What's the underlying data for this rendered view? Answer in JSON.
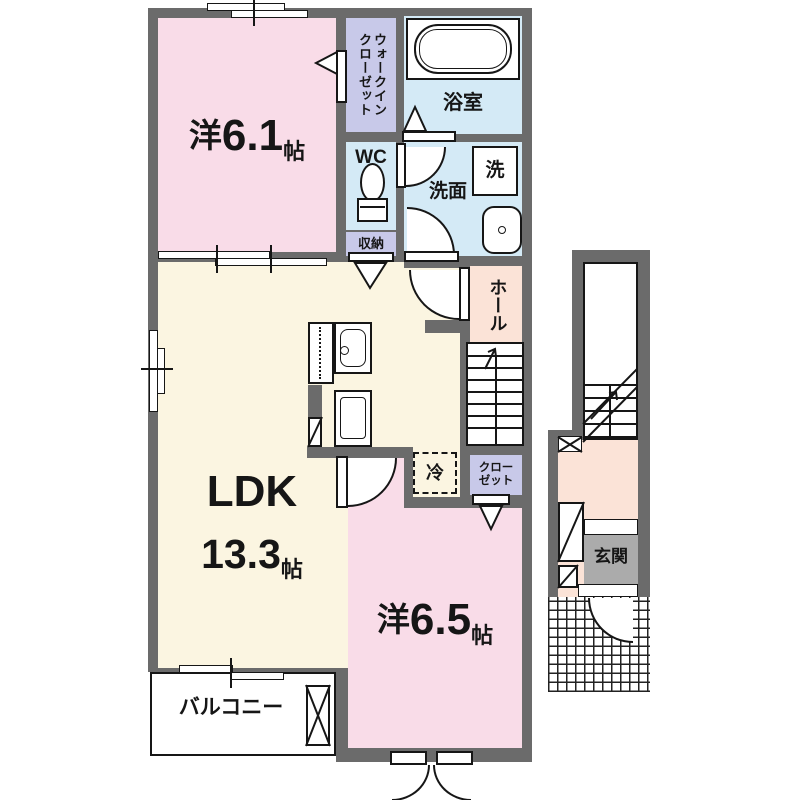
{
  "title": "apartment-floor-plan",
  "rooms": {
    "western_6_1": {
      "prefix": "洋",
      "size": "6.1",
      "unit": "帖"
    },
    "walk_in_closet": {
      "label": "ウォークイン\nクローゼット"
    },
    "bathroom": {
      "label": "浴室"
    },
    "toilet": {
      "label": "WC"
    },
    "washer": {
      "label": "洗"
    },
    "washroom": {
      "label": "洗面"
    },
    "storage": {
      "label": "収納"
    },
    "hall": {
      "label": "ホール"
    },
    "ldk": {
      "label": "LDK",
      "size": "13.3",
      "unit": "帖"
    },
    "refrigerator": {
      "label": "冷"
    },
    "closet": {
      "label": "クロー\nゼット"
    },
    "western_6_5": {
      "prefix": "洋",
      "size": "6.5",
      "unit": "帖"
    },
    "balcony": {
      "label": "バルコニー"
    },
    "entrance": {
      "label": "玄関"
    }
  },
  "colors": {
    "wall": "#6b6b6b",
    "room_pink": "#f9dce8",
    "room_cream": "#fbf5e1",
    "room_blue": "#d4eaf6",
    "room_lavender": "#c8c9e9",
    "room_peach": "#fbe3d7",
    "entrance_gray": "#ababab",
    "line": "#161616"
  }
}
